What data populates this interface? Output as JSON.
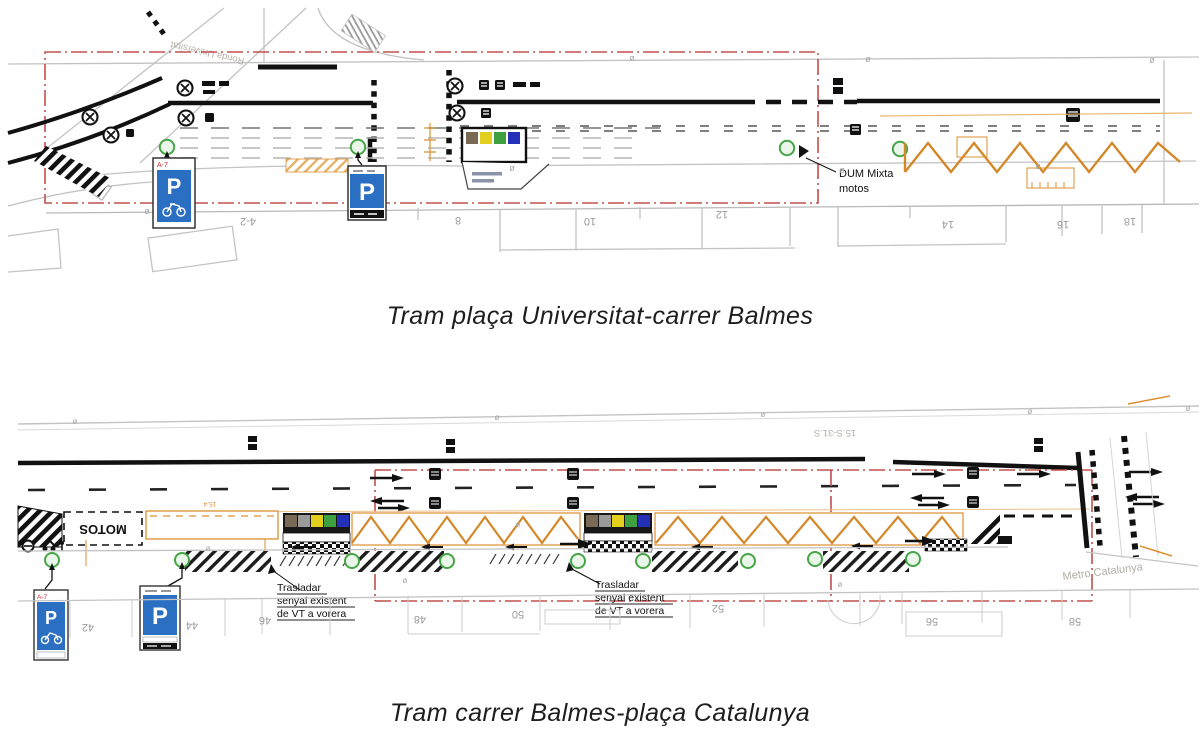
{
  "page": {
    "background": "#ffffff"
  },
  "colors": {
    "boundary_red": "#c0504d",
    "accent_orange": "#dd8f33",
    "zigzag_orange": "#d4882a",
    "sign_blue": "#2b6fc2",
    "sign_code_red": "#cc2b2b",
    "tree_green": "#46a546",
    "tree_fill": "#eaf6ea",
    "container_brown": "#7a6a55",
    "container_gray": "#9a9a9a",
    "container_yellow": "#e3cf1e",
    "container_green": "#3fa03f",
    "container_blue": "#2530b8",
    "ink": "#111111",
    "plan_gray": "#c3c3c3",
    "faint_text": "#9a9a9a"
  },
  "top_figure": {
    "caption": "Tram plaça Universitat-carrer Balmes",
    "street_label": "Ronda Universitat",
    "dum_label_line1": "DUM Mixta",
    "dum_label_line2": "motos",
    "sign_code": "A-7",
    "parking_letter": "P",
    "building_numbers": [
      "4-2",
      "8",
      "10",
      "12",
      "14",
      "16",
      "18"
    ]
  },
  "bottom_figure": {
    "caption": "Tram carrer Balmes-plaça Catalunya",
    "motos_label": "MOTOS",
    "relocate_note_line1": "Trasladar",
    "relocate_note_line2": "senyal existent",
    "relocate_note_line3": "de VT a vorera",
    "metro_label": "Metro Catalunya",
    "section_label": "15.S-31.S",
    "dimension_label": "15.4",
    "sign_code": "A-7",
    "parking_letter": "P",
    "building_numbers": [
      "42",
      "44",
      "46",
      "48",
      "50",
      "52",
      "56",
      "58"
    ]
  }
}
